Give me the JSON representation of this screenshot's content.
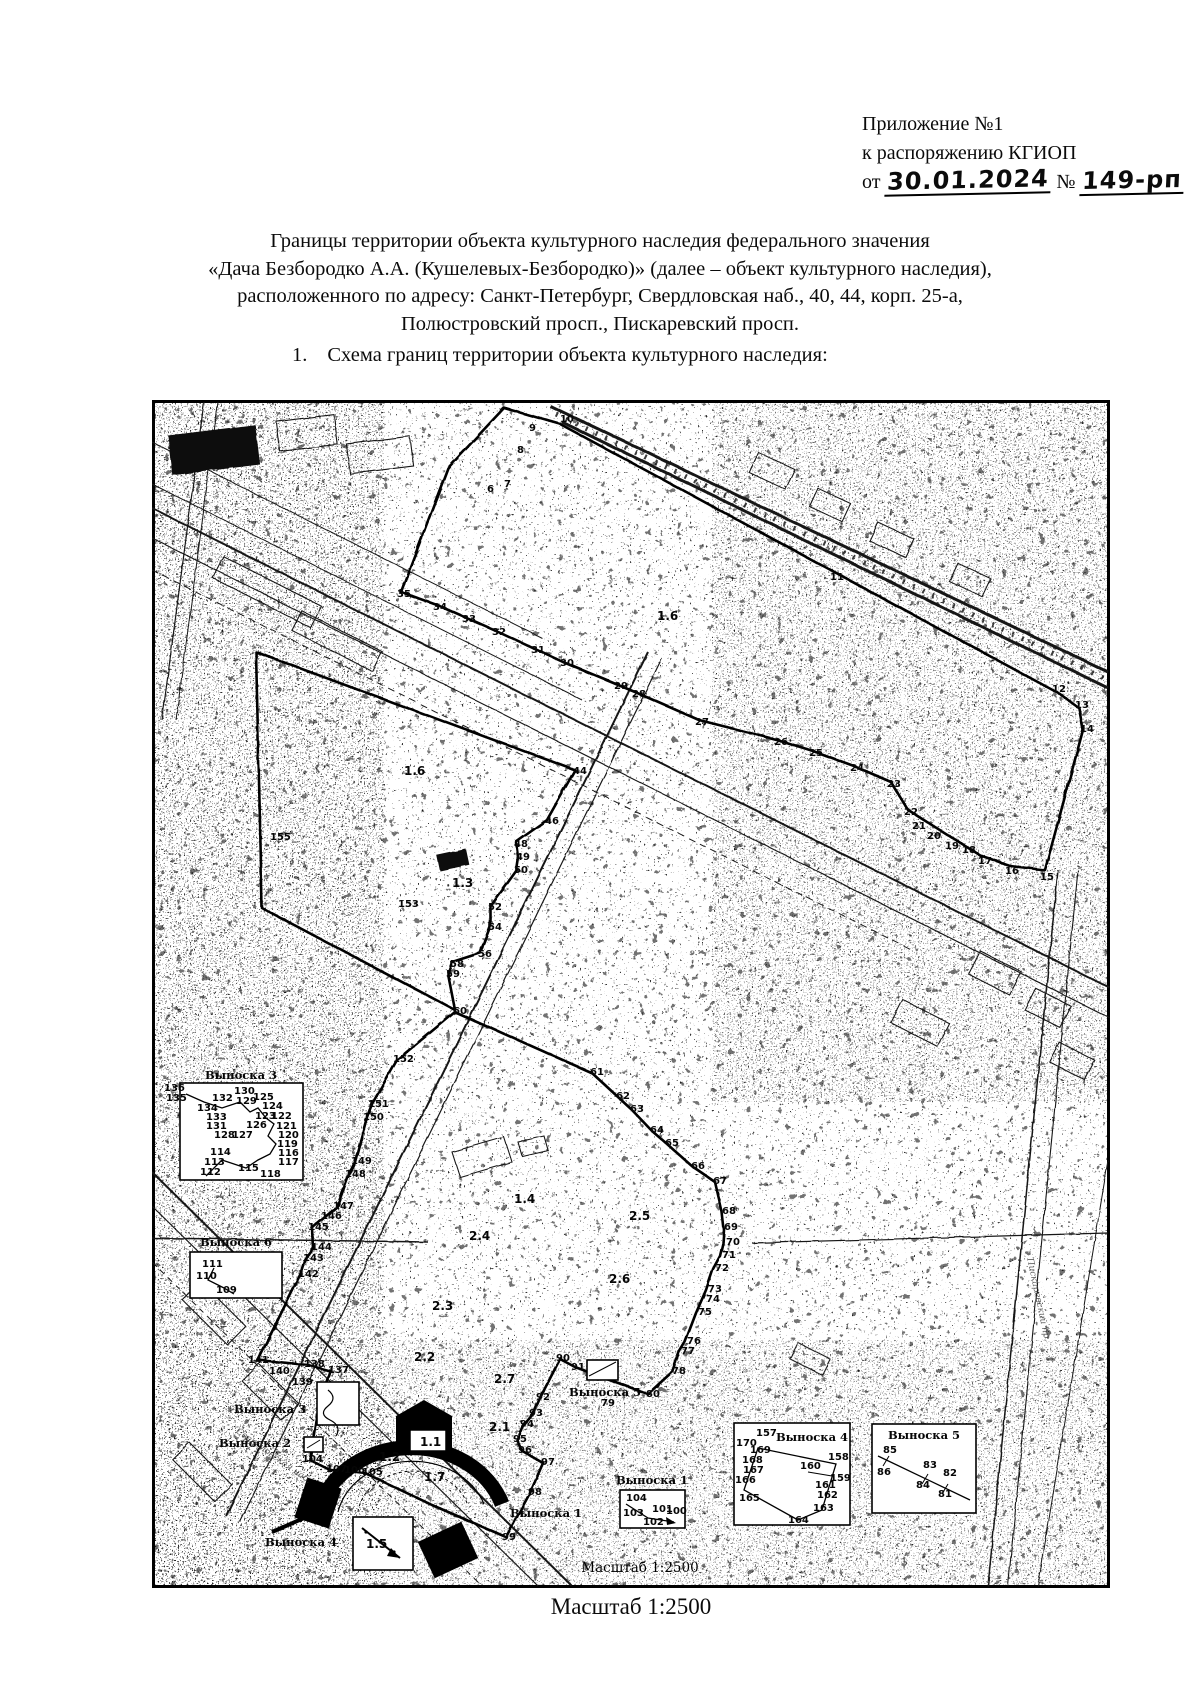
{
  "header": {
    "line1": "Приложение №1",
    "line2": "к распоряжению КГИОП",
    "from_label": "от",
    "date": "30.01.2024",
    "number_sign": "№",
    "number": "149-рп"
  },
  "title": {
    "line1": "Границы территории объекта культурного наследия федерального значения",
    "line2": "«Дача Безбородко А.А. (Кушелевых-Безбородко)» (далее – объект культурного наследия),",
    "line3": "расположенного по адресу: Санкт-Петербург, Свердловская наб., 40, 44, корп. 25-а,",
    "line4": "Полюстровский просп., Пискаревский просп."
  },
  "section": {
    "number": "1.",
    "text": "Схема границ территории объекта культурного наследия:"
  },
  "caption": "Масштаб 1:2500",
  "map": {
    "scale_inner": {
      "t": "Масштаб 1:2500",
      "x": 488,
      "y": 1172
    },
    "street_labels": [
      {
        "t": "Пискаревский пр.",
        "x": 884,
        "y": 900,
        "r": 78
      },
      {
        "t": "Свердловская наб.",
        "x": 120,
        "y": 1058,
        "r": 35
      }
    ],
    "area_labels": [
      {
        "t": "1.6",
        "x": 505,
        "y": 220
      },
      {
        "t": "1.6",
        "x": 252,
        "y": 375
      },
      {
        "t": "1.3",
        "x": 300,
        "y": 487
      },
      {
        "t": "1.4",
        "x": 362,
        "y": 803
      },
      {
        "t": "2.4",
        "x": 317,
        "y": 840
      },
      {
        "t": "2.5",
        "x": 477,
        "y": 820
      },
      {
        "t": "2.6",
        "x": 457,
        "y": 883
      },
      {
        "t": "2.3",
        "x": 280,
        "y": 910
      },
      {
        "t": "2.2",
        "x": 262,
        "y": 961
      },
      {
        "t": "2.7",
        "x": 342,
        "y": 983
      },
      {
        "t": "2.1",
        "x": 337,
        "y": 1031
      },
      {
        "t": "1.2",
        "x": 227,
        "y": 1061
      },
      {
        "t": "1.7",
        "x": 272,
        "y": 1081
      },
      {
        "t": "1.5",
        "x": 214,
        "y": 1148
      },
      {
        "t": "1.1",
        "x": 268,
        "y": 1046
      }
    ],
    "callout_location_labels": [
      {
        "t": "Выноска 3",
        "x": 118,
        "y": 1013
      },
      {
        "t": "Выноска 2",
        "x": 103,
        "y": 1047
      },
      {
        "t": "Выноска 4",
        "x": 149,
        "y": 1146
      },
      {
        "t": "Выноска 1",
        "x": 394,
        "y": 1117
      },
      {
        "t": "Выноска 5",
        "x": 453,
        "y": 996
      }
    ],
    "point_labels": [
      {
        "t": "6",
        "x": 335,
        "y": 92
      },
      {
        "t": "7",
        "x": 352,
        "y": 87
      },
      {
        "t": "8",
        "x": 365,
        "y": 53
      },
      {
        "t": "9",
        "x": 377,
        "y": 31
      },
      {
        "t": "10",
        "x": 408,
        "y": 22
      },
      {
        "t": "11",
        "x": 678,
        "y": 180
      },
      {
        "t": "12",
        "x": 900,
        "y": 292
      },
      {
        "t": "13",
        "x": 923,
        "y": 308
      },
      {
        "t": "14",
        "x": 928,
        "y": 332
      },
      {
        "t": "15",
        "x": 888,
        "y": 480
      },
      {
        "t": "16",
        "x": 853,
        "y": 474
      },
      {
        "t": "17",
        "x": 826,
        "y": 464
      },
      {
        "t": "18",
        "x": 810,
        "y": 453
      },
      {
        "t": "19",
        "x": 793,
        "y": 449
      },
      {
        "t": "20",
        "x": 775,
        "y": 439
      },
      {
        "t": "21",
        "x": 760,
        "y": 429
      },
      {
        "t": "22",
        "x": 752,
        "y": 415
      },
      {
        "t": "23",
        "x": 735,
        "y": 387
      },
      {
        "t": "24",
        "x": 698,
        "y": 371
      },
      {
        "t": "25",
        "x": 657,
        "y": 356
      },
      {
        "t": "26",
        "x": 622,
        "y": 345
      },
      {
        "t": "27",
        "x": 543,
        "y": 325
      },
      {
        "t": "28",
        "x": 480,
        "y": 297
      },
      {
        "t": "29",
        "x": 462,
        "y": 289
      },
      {
        "t": "30",
        "x": 408,
        "y": 266
      },
      {
        "t": "31",
        "x": 379,
        "y": 253
      },
      {
        "t": "32",
        "x": 340,
        "y": 235
      },
      {
        "t": "33",
        "x": 310,
        "y": 222
      },
      {
        "t": "34",
        "x": 281,
        "y": 210
      },
      {
        "t": "35",
        "x": 245,
        "y": 197
      },
      {
        "t": "44",
        "x": 421,
        "y": 374
      },
      {
        "t": "46",
        "x": 393,
        "y": 424
      },
      {
        "t": "48",
        "x": 362,
        "y": 447
      },
      {
        "t": "49",
        "x": 364,
        "y": 460
      },
      {
        "t": "50",
        "x": 362,
        "y": 473
      },
      {
        "t": "52",
        "x": 336,
        "y": 510
      },
      {
        "t": "54",
        "x": 336,
        "y": 530
      },
      {
        "t": "56",
        "x": 326,
        "y": 557
      },
      {
        "t": "58",
        "x": 298,
        "y": 567
      },
      {
        "t": "59",
        "x": 294,
        "y": 577
      },
      {
        "t": "60",
        "x": 301,
        "y": 614
      },
      {
        "t": "61",
        "x": 438,
        "y": 675
      },
      {
        "t": "62",
        "x": 464,
        "y": 699
      },
      {
        "t": "63",
        "x": 478,
        "y": 712
      },
      {
        "t": "64",
        "x": 498,
        "y": 733
      },
      {
        "t": "65",
        "x": 513,
        "y": 746
      },
      {
        "t": "66",
        "x": 539,
        "y": 769
      },
      {
        "t": "67",
        "x": 561,
        "y": 784
      },
      {
        "t": "68",
        "x": 570,
        "y": 814
      },
      {
        "t": "69",
        "x": 572,
        "y": 830
      },
      {
        "t": "70",
        "x": 574,
        "y": 845
      },
      {
        "t": "71",
        "x": 570,
        "y": 858
      },
      {
        "t": "72",
        "x": 563,
        "y": 871
      },
      {
        "t": "73",
        "x": 556,
        "y": 892
      },
      {
        "t": "74",
        "x": 554,
        "y": 902
      },
      {
        "t": "75",
        "x": 546,
        "y": 915
      },
      {
        "t": "76",
        "x": 535,
        "y": 944
      },
      {
        "t": "77",
        "x": 529,
        "y": 954
      },
      {
        "t": "78",
        "x": 520,
        "y": 974
      },
      {
        "t": "79",
        "x": 449,
        "y": 1006
      },
      {
        "t": "80",
        "x": 494,
        "y": 997
      },
      {
        "t": "90",
        "x": 404,
        "y": 961
      },
      {
        "t": "91",
        "x": 419,
        "y": 970
      },
      {
        "t": "92",
        "x": 384,
        "y": 1000
      },
      {
        "t": "93",
        "x": 377,
        "y": 1016
      },
      {
        "t": "94",
        "x": 368,
        "y": 1027
      },
      {
        "t": "95",
        "x": 361,
        "y": 1042
      },
      {
        "t": "96",
        "x": 366,
        "y": 1053
      },
      {
        "t": "97",
        "x": 389,
        "y": 1065
      },
      {
        "t": "98",
        "x": 376,
        "y": 1095
      },
      {
        "t": "99",
        "x": 350,
        "y": 1140
      },
      {
        "t": "104",
        "x": 150,
        "y": 1062
      },
      {
        "t": "107",
        "x": 174,
        "y": 1072
      },
      {
        "t": "106",
        "x": 192,
        "y": 1073
      },
      {
        "t": "105",
        "x": 210,
        "y": 1075
      },
      {
        "t": "137",
        "x": 176,
        "y": 973
      },
      {
        "t": "138",
        "x": 152,
        "y": 967
      },
      {
        "t": "139",
        "x": 140,
        "y": 985
      },
      {
        "t": "140",
        "x": 117,
        "y": 974
      },
      {
        "t": "141",
        "x": 96,
        "y": 963
      },
      {
        "t": "142",
        "x": 146,
        "y": 877
      },
      {
        "t": "143",
        "x": 151,
        "y": 861
      },
      {
        "t": "144",
        "x": 159,
        "y": 850
      },
      {
        "t": "145",
        "x": 156,
        "y": 830
      },
      {
        "t": "146",
        "x": 169,
        "y": 819
      },
      {
        "t": "147",
        "x": 181,
        "y": 809
      },
      {
        "t": "148",
        "x": 193,
        "y": 777
      },
      {
        "t": "149",
        "x": 199,
        "y": 764
      },
      {
        "t": "150",
        "x": 211,
        "y": 720
      },
      {
        "t": "151",
        "x": 216,
        "y": 707
      },
      {
        "t": "152",
        "x": 241,
        "y": 662
      },
      {
        "t": "153",
        "x": 246,
        "y": 507
      },
      {
        "t": "155",
        "x": 118,
        "y": 440
      }
    ],
    "callout_boxes": [
      {
        "label": "Выноска 3",
        "x": 28,
        "y": 683,
        "w": 123,
        "h": 97,
        "lx": 89,
        "ly": 679,
        "points": [
          {
            "t": "136",
            "x": 12,
            "y": 691
          },
          {
            "t": "135",
            "x": 14,
            "y": 701
          },
          {
            "t": "132",
            "x": 60,
            "y": 701
          },
          {
            "t": "130",
            "x": 82,
            "y": 694
          },
          {
            "t": "129",
            "x": 84,
            "y": 704
          },
          {
            "t": "125",
            "x": 101,
            "y": 700
          },
          {
            "t": "124",
            "x": 110,
            "y": 709
          },
          {
            "t": "134",
            "x": 45,
            "y": 711
          },
          {
            "t": "133",
            "x": 54,
            "y": 720
          },
          {
            "t": "123",
            "x": 103,
            "y": 719
          },
          {
            "t": "122",
            "x": 119,
            "y": 719
          },
          {
            "t": "131",
            "x": 54,
            "y": 729
          },
          {
            "t": "126",
            "x": 94,
            "y": 728
          },
          {
            "t": "121",
            "x": 124,
            "y": 729
          },
          {
            "t": "128",
            "x": 62,
            "y": 738
          },
          {
            "t": "127",
            "x": 80,
            "y": 738
          },
          {
            "t": "120",
            "x": 126,
            "y": 738
          },
          {
            "t": "119",
            "x": 125,
            "y": 747
          },
          {
            "t": "114",
            "x": 58,
            "y": 755
          },
          {
            "t": "116",
            "x": 126,
            "y": 756
          },
          {
            "t": "113",
            "x": 52,
            "y": 765
          },
          {
            "t": "115",
            "x": 86,
            "y": 771
          },
          {
            "t": "117",
            "x": 126,
            "y": 765
          },
          {
            "t": "112",
            "x": 48,
            "y": 775
          },
          {
            "t": "118",
            "x": 108,
            "y": 777
          }
        ]
      },
      {
        "label": "Выноска 6",
        "x": 38,
        "y": 852,
        "w": 92,
        "h": 46,
        "lx": 84,
        "ly": 846,
        "points": [
          {
            "t": "111",
            "x": 50,
            "y": 867
          },
          {
            "t": "110",
            "x": 44,
            "y": 879
          },
          {
            "t": "109",
            "x": 64,
            "y": 893
          }
        ]
      },
      {
        "label": "Выноска 1",
        "x": 468,
        "y": 1090,
        "w": 65,
        "h": 38,
        "lx": 500,
        "ly": 1084,
        "points": [
          {
            "t": "104",
            "x": 474,
            "y": 1101
          },
          {
            "t": "103",
            "x": 471,
            "y": 1116
          },
          {
            "t": "102",
            "x": 491,
            "y": 1125
          },
          {
            "t": "101",
            "x": 500,
            "y": 1112
          },
          {
            "t": "100",
            "x": 514,
            "y": 1114
          }
        ]
      },
      {
        "label": "Выноска 4",
        "x": 582,
        "y": 1023,
        "w": 116,
        "h": 102,
        "lx": 660,
        "ly": 1041,
        "points": [
          {
            "t": "157",
            "x": 604,
            "y": 1036
          },
          {
            "t": "170",
            "x": 584,
            "y": 1046
          },
          {
            "t": "169",
            "x": 598,
            "y": 1053
          },
          {
            "t": "168",
            "x": 590,
            "y": 1063
          },
          {
            "t": "167",
            "x": 591,
            "y": 1073
          },
          {
            "t": "166",
            "x": 583,
            "y": 1083
          },
          {
            "t": "165",
            "x": 587,
            "y": 1101
          },
          {
            "t": "158",
            "x": 676,
            "y": 1060
          },
          {
            "t": "160",
            "x": 648,
            "y": 1069
          },
          {
            "t": "159",
            "x": 678,
            "y": 1081
          },
          {
            "t": "161",
            "x": 663,
            "y": 1088
          },
          {
            "t": "162",
            "x": 665,
            "y": 1098
          },
          {
            "t": "163",
            "x": 661,
            "y": 1111
          },
          {
            "t": "164",
            "x": 636,
            "y": 1123
          }
        ]
      },
      {
        "label": "Выноска 5",
        "x": 720,
        "y": 1024,
        "w": 104,
        "h": 89,
        "lx": 772,
        "ly": 1039,
        "points": [
          {
            "t": "85",
            "x": 731,
            "y": 1053
          },
          {
            "t": "86",
            "x": 725,
            "y": 1075
          },
          {
            "t": "83",
            "x": 771,
            "y": 1068
          },
          {
            "t": "84",
            "x": 764,
            "y": 1088
          },
          {
            "t": "82",
            "x": 791,
            "y": 1076
          },
          {
            "t": "81",
            "x": 786,
            "y": 1097
          }
        ]
      }
    ]
  }
}
